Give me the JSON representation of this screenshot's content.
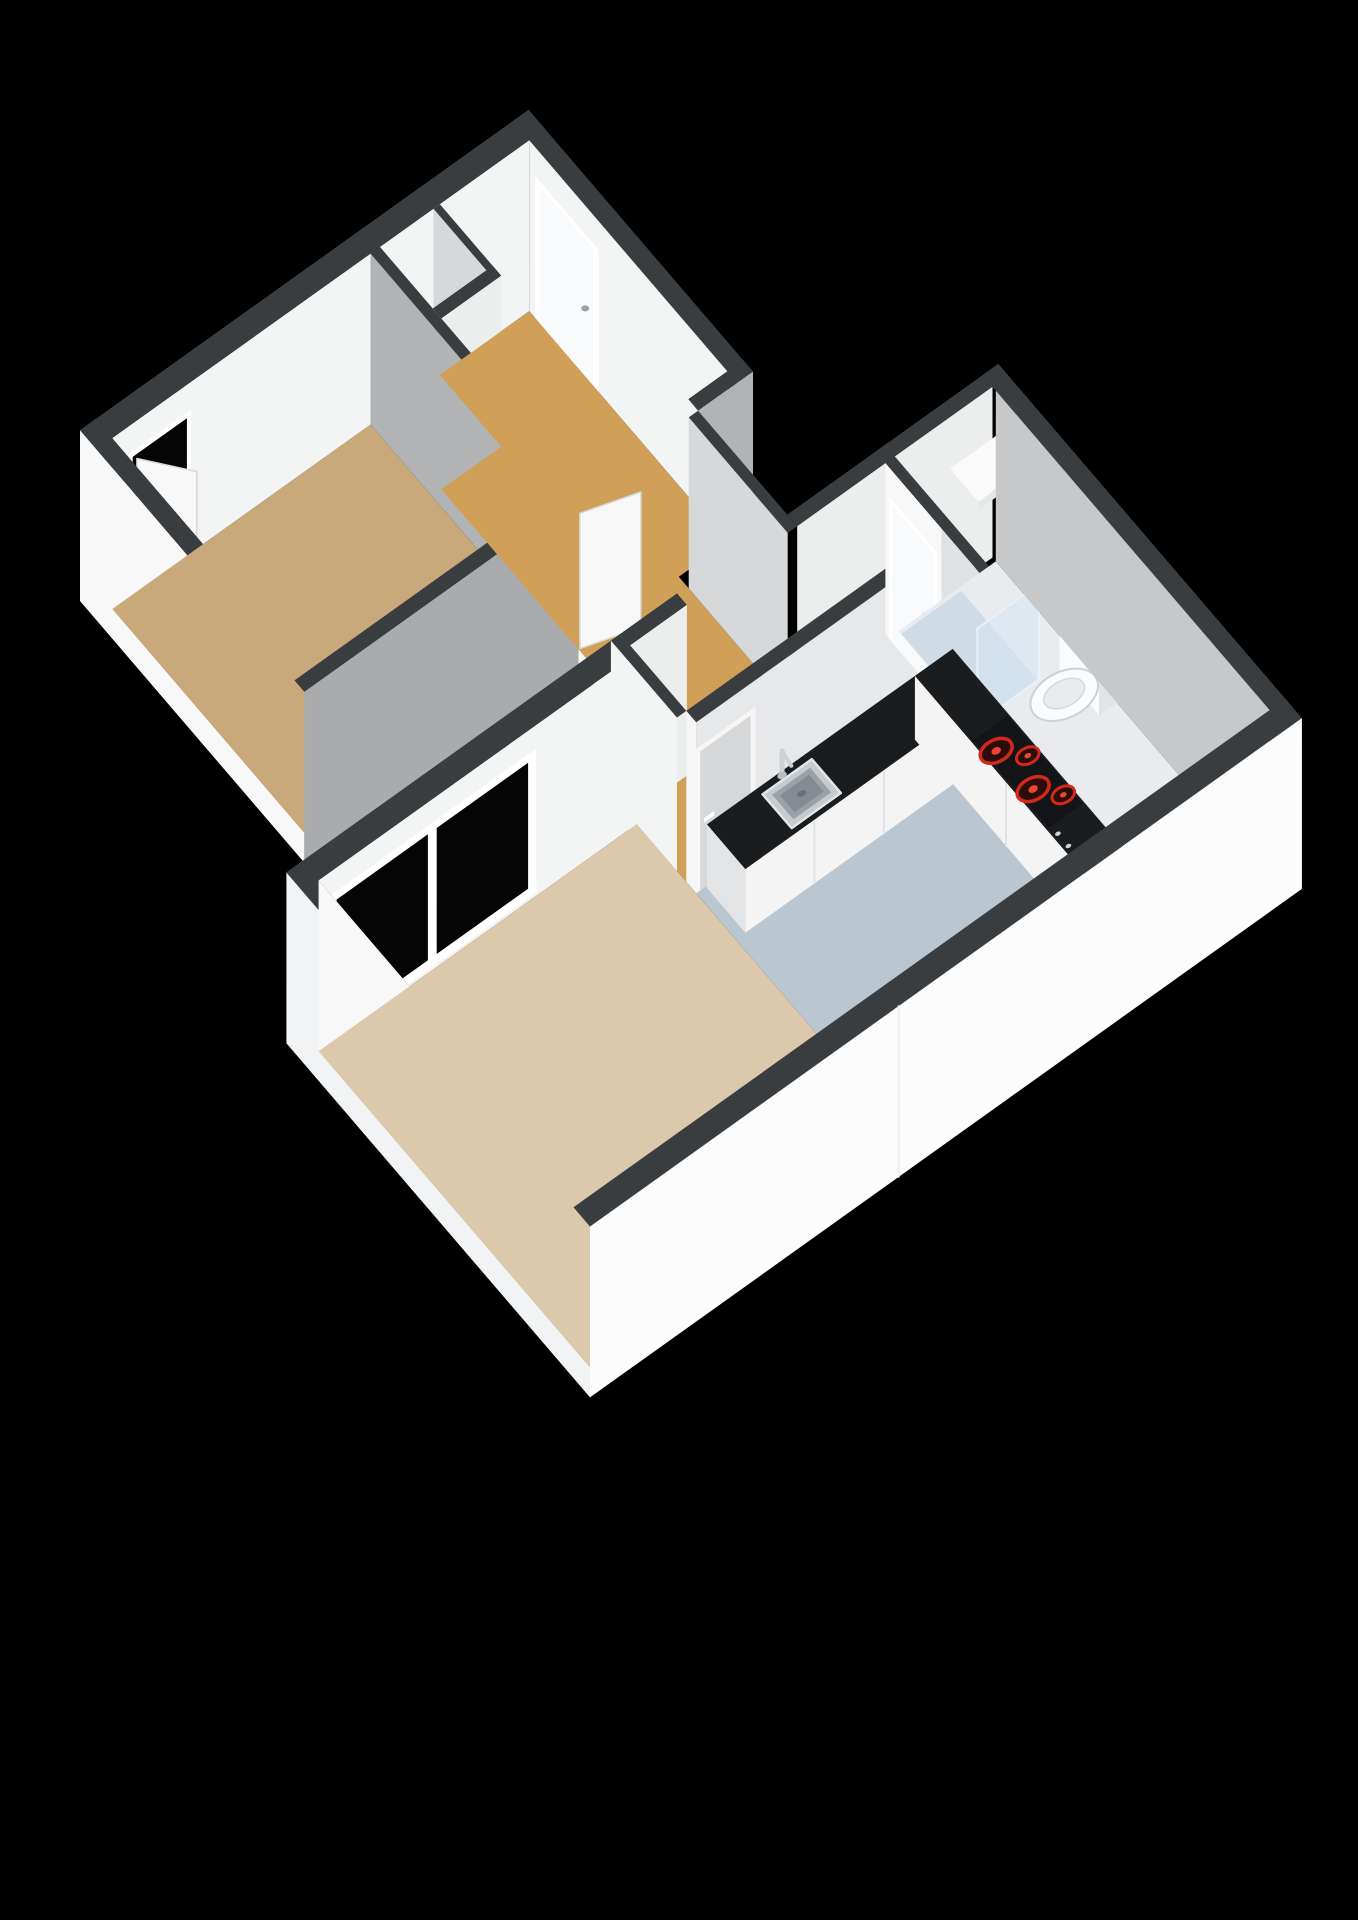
{
  "image": {
    "kind": "3d-floorplan-render",
    "background": "#000000",
    "view": "isometric-birdseye"
  },
  "palette": {
    "bg": "#000000",
    "wallTop": "#3a3d40",
    "wallBright": "#f8f8f8",
    "wallWhite": "#f3f4f4",
    "wallLight": "#eceded",
    "wallSoft": "#e7e8ea",
    "wallShadeA": "#a9abad",
    "wallShadeB": "#b1b3b5",
    "wallShadeC": "#c6c8ca",
    "wallShadeD": "#d7d8da",
    "capWhite": "#f6f6f6",
    "floorBedroom": "#c9a97c",
    "floorHall": "#d0a058",
    "floorLiving": "#dcc9ab",
    "floorKitchen": "#bac6d0",
    "floorBath": "#e9ebee",
    "floorCloset": "#e0e1e2",
    "showerTray": "#cfdce6",
    "counterTop": "#1b1c1e",
    "cabinetFront": "#f4f4f4",
    "cabinetSide": "#e3e4e5",
    "steelRim": "#c6cbcf",
    "steelMid": "#9aa1a7",
    "steelDeep": "#848b92",
    "steelEdge": "#e2e6e9",
    "drain": "#6a7177",
    "faucet": "#ccd1d5",
    "cooktop": "#131417",
    "burnerRing": "#d2281c",
    "burnerFill": "#2c0d0a",
    "burnerDot": "#ea4433",
    "knobDot": "#cfd3d6",
    "doorGray": "#d6d7d9",
    "doorWhite": "#f9fafb",
    "frameWhite": "#ffffff",
    "openingBlack": "#050505",
    "glassFill": "rgba(213,230,242,0.5)",
    "glassEdge": "#e8f1f8",
    "toiletWhite": "#fafbfc",
    "toiletTopTone": "#eef0f2",
    "toiletSide": "#e2e5e8",
    "toiletSeat": "#e8ecef",
    "fixtureLine": "#ccd1d5",
    "shelfWhite": "#fafafa",
    "shelfEdge": "#e6e7e8",
    "windowGlass": "#050505",
    "panelEdge": "#d8d8d8"
  },
  "rooms": [
    {
      "id": "bedroom",
      "label": "bedroom",
      "floor": "floorBedroom"
    },
    {
      "id": "hallway",
      "label": "hallway",
      "floor": "floorHall"
    },
    {
      "id": "closet",
      "label": "closet",
      "floor": "floorCloset"
    },
    {
      "id": "living-room",
      "label": "living room",
      "floor": "floorLiving"
    },
    {
      "id": "kitchen",
      "label": "kitchen",
      "floor": "floorKitchen"
    },
    {
      "id": "bathroom",
      "label": "bathroom",
      "floor": "floorBath"
    }
  ],
  "fixtures": [
    {
      "id": "kitchen-sink",
      "label": "stainless steel sink with faucet"
    },
    {
      "id": "cooktop",
      "label": "cooktop with four red burners"
    },
    {
      "id": "kitchen-counter",
      "label": "L-shaped counter, black top, white cabinets"
    },
    {
      "id": "toilet",
      "label": "toilet"
    },
    {
      "id": "shower-glass",
      "label": "glass shower screen"
    },
    {
      "id": "bath-shelf",
      "label": "white shelf"
    },
    {
      "id": "living-window",
      "label": "large sliding window, dark glass"
    },
    {
      "id": "hall-cabinet",
      "label": "small white cabinet"
    }
  ],
  "doors": [
    {
      "id": "bedroom-exterior-door",
      "state": "ajar"
    },
    {
      "id": "bedroom-hall-door",
      "state": "open"
    },
    {
      "id": "front-door",
      "state": "closed"
    },
    {
      "id": "kitchen-hall-door",
      "state": "closed",
      "color": "doorGray"
    },
    {
      "id": "bathroom-door",
      "state": "closed"
    }
  ]
}
